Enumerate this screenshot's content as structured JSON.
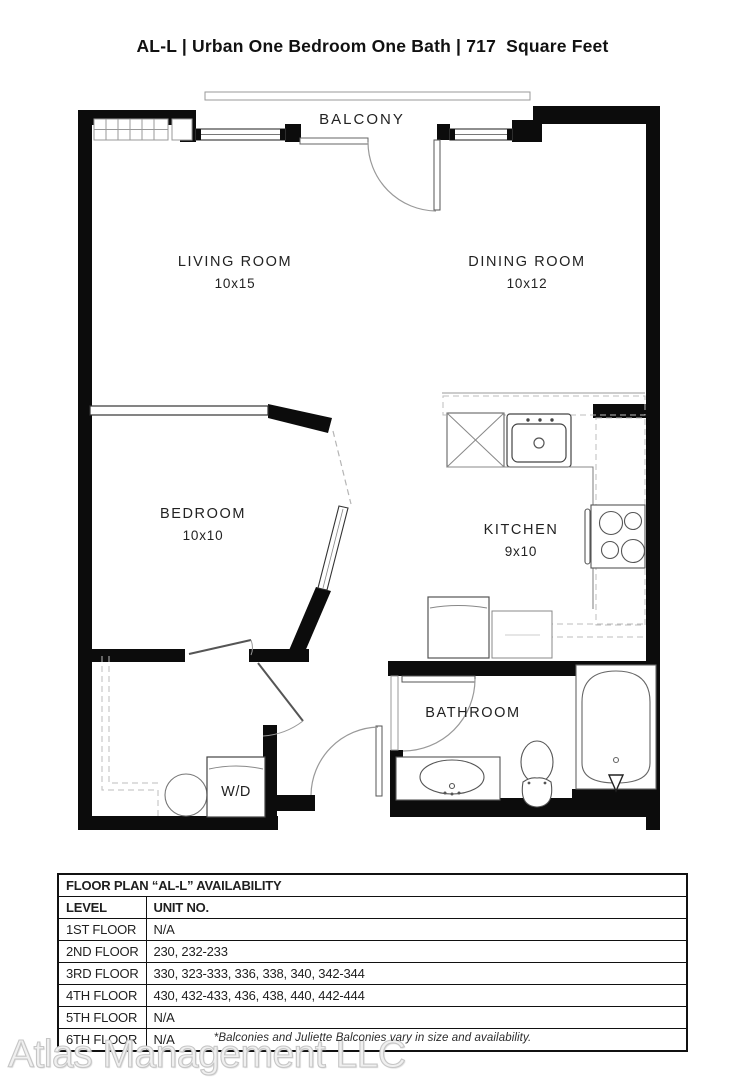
{
  "title": "AL-L | Urban One Bedroom One Bath | 717  Square Feet",
  "plan": {
    "balcony_label": "BALCONY",
    "rooms": [
      {
        "name": "LIVING ROOM",
        "dims": "10x15"
      },
      {
        "name": "DINING ROOM",
        "dims": "10x12"
      },
      {
        "name": "BEDROOM",
        "dims": "10x10"
      },
      {
        "name": "KITCHEN",
        "dims": "9x10"
      },
      {
        "name": "BATHROOM",
        "dims": ""
      },
      {
        "name": "W/D",
        "dims": ""
      }
    ]
  },
  "availability_table": {
    "title": "FLOOR PLAN “AL-L” AVAILABILITY",
    "columns": [
      "LEVEL",
      "UNIT NO."
    ],
    "rows": [
      [
        "1ST FLOOR",
        "N/A"
      ],
      [
        "2ND FLOOR",
        "230, 232-233"
      ],
      [
        "3RD FLOOR",
        "330, 323-333, 336, 338, 340, 342-344"
      ],
      [
        "4TH FLOOR",
        "430, 432-433, 436, 438, 440, 442-444"
      ],
      [
        "5TH FLOOR",
        "N/A"
      ],
      [
        "6TH FLOOR",
        "N/A"
      ]
    ]
  },
  "footnote": "*Balconies and Juliette Balconies vary in size and availability.",
  "watermark": "Atlas Management LLC",
  "colors": {
    "wall": "#0c0c0c",
    "fixture_line": "#555555",
    "dashed_line": "#b5b5b5",
    "text": "#1f1f1f",
    "watermark": "#c6c6c6"
  }
}
